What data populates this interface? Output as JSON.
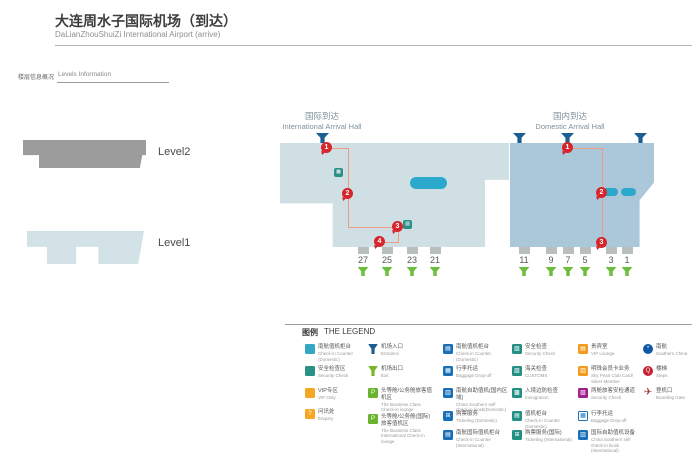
{
  "header": {
    "title_zh": "大连周水子国际机场（到达）",
    "title_en": "DaLianZhouShuiZi International Airport (arrive)"
  },
  "levels": {
    "label_zh": "楼层信息概况",
    "label_en": "Levels Information",
    "level2": "Level2",
    "level1": "Level1"
  },
  "map": {
    "international": {
      "hall_zh": "国际到达",
      "hall_en": "International Arrival Hall",
      "gates": [
        "27",
        "25",
        "23",
        "21"
      ],
      "route_markers": [
        "1",
        "2",
        "3",
        "4"
      ]
    },
    "domestic": {
      "hall_zh": "国内到达",
      "hall_en": "Domestic Arrival Hall",
      "gates": [
        "11",
        "9",
        "7",
        "5",
        "3",
        "1"
      ],
      "route_markers": [
        "1",
        "2",
        "3"
      ]
    }
  },
  "legend": {
    "title_zh": "图例",
    "title_en": "THE LEGEND",
    "columns": [
      {
        "items": [
          {
            "zh": "南航值机柜台",
            "en": "Check-in Counter (Domestic)"
          },
          {
            "zh": "安全检查区",
            "en": "Security Check"
          },
          {
            "zh": "VIP专区",
            "en": "VIP Only"
          },
          {
            "zh": "问讯处",
            "en": "Enquiry"
          }
        ]
      },
      {
        "items": [
          {
            "zh": "机场入口",
            "en": "Entrance"
          },
          {
            "zh": "机场出口",
            "en": "Exit"
          },
          {
            "zh": "头等舱/公务舱旅客值机区",
            "en": "The Business Class Check-in lounge"
          },
          {
            "zh": "头等舱/公务舱(国际)旅客值机区",
            "en": "The Business Class International Check-in lounge"
          }
        ]
      },
      {
        "items": [
          {
            "zh": "南航值机柜台",
            "en": "Check-in Counter (Domestic)"
          },
          {
            "zh": "行李托运",
            "en": "Baggage Drop-off"
          },
          {
            "zh": "南航自助值机(国内区域)",
            "en": "China Southern self check-in kiosk(Domestic)"
          },
          {
            "zh": "购票服务",
            "en": "Ticketing (Domestic)"
          },
          {
            "zh": "南航国际值机柜台",
            "en": "Check-in Counter (International)"
          }
        ]
      },
      {
        "items": [
          {
            "zh": "安全检查",
            "en": "Security Check"
          },
          {
            "zh": "海关检查",
            "en": "CUSTOMS"
          },
          {
            "zh": "入境边防检查",
            "en": "Immigration"
          },
          {
            "zh": "值机柜台",
            "en": "Check-in Counter (Domestic)"
          },
          {
            "zh": "购票服务(国际)",
            "en": "Ticketing (International)"
          }
        ]
      },
      {
        "items": [
          {
            "zh": "贵宾室",
            "en": "VIP Lounge"
          },
          {
            "zh": "明珠会员卡业务",
            "en": "Sky Pearl Club Card/ Silver Member"
          },
          {
            "zh": "两舱旅客安检通道",
            "en": "Security Check"
          },
          {
            "zh": "行李托运",
            "en": "Baggage Drop-off"
          },
          {
            "zh": "国际自助值机设备",
            "en": "China Southern self check-in kiosk (International)"
          }
        ]
      },
      {
        "items": [
          {
            "zh": "南航",
            "en": "Southern China"
          },
          {
            "zh": "楼梯",
            "en": "Steps"
          },
          {
            "zh": "登机口",
            "en": "Boarding Gate"
          }
        ]
      }
    ]
  },
  "colors": {
    "international_hall": "#cfdfe3",
    "domestic_hall": "#aac8da",
    "level2": "#9c9c9c",
    "level1": "#d3e2e7",
    "baggage_belt": "#2ba9cc",
    "route_line": "#eb9c82",
    "route_marker": "#d6262c",
    "entrance_arrow": "#1d5e92",
    "exit_arrow": "#6cbf3e",
    "gate_block": "#b9bebe"
  }
}
